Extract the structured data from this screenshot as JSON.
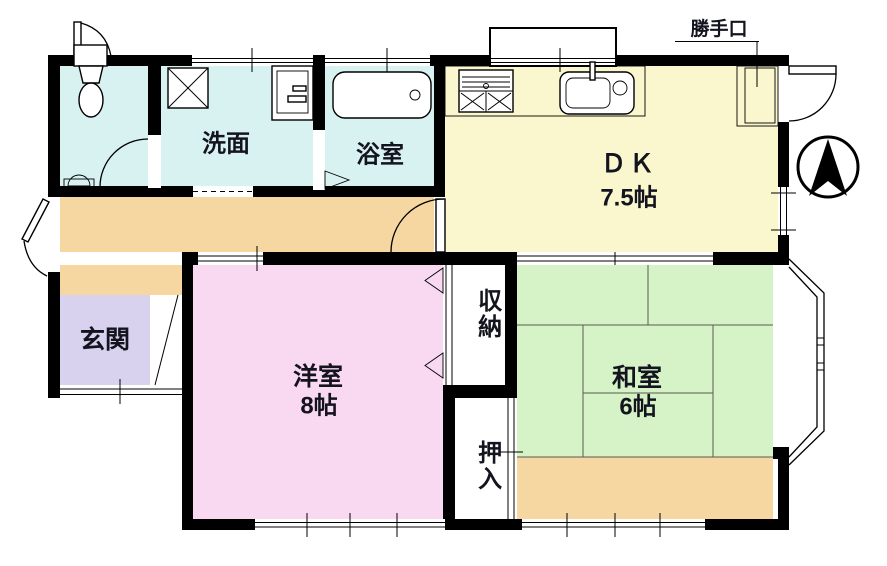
{
  "title": "2DK間取り図",
  "labels": {
    "katteguchi": "勝手口",
    "senmen": "洗面",
    "yokushitsu": "浴室",
    "dk_name": "ＤＫ",
    "dk_size": "7.5帖",
    "genkan": "玄関",
    "yoshitsu_name": "洋室",
    "yoshitsu_size": "8帖",
    "shunou": "収納",
    "oshiire": "押入",
    "washitsu_name": "和室",
    "washitsu_size": "6帖"
  },
  "compass": {
    "icon": "north-arrow",
    "direction": "N"
  },
  "rooms": [
    {
      "name": "トイレ",
      "label": ""
    },
    {
      "name": "洗面",
      "label": "洗面"
    },
    {
      "name": "浴室",
      "label": "浴室"
    },
    {
      "name": "ダイニングキッチン",
      "label": "ＤＫ",
      "size": "7.5帖"
    },
    {
      "name": "玄関",
      "label": "玄関"
    },
    {
      "name": "洋室",
      "label": "洋室",
      "size": "8帖"
    },
    {
      "name": "収納",
      "label": "収納"
    },
    {
      "name": "押入",
      "label": "押入"
    },
    {
      "name": "和室",
      "label": "和室",
      "size": "6帖"
    }
  ],
  "colors": {
    "wall": "#000000",
    "water_rooms": "#d8f1f1",
    "dk": "#faf6cd",
    "hallway": "#f6d7a1",
    "genkan": "#d8d2ef",
    "western_room": "#f9d9f2",
    "tatami_room": "#d6f3c8",
    "background": "#ffffff",
    "text": "#14141e"
  }
}
